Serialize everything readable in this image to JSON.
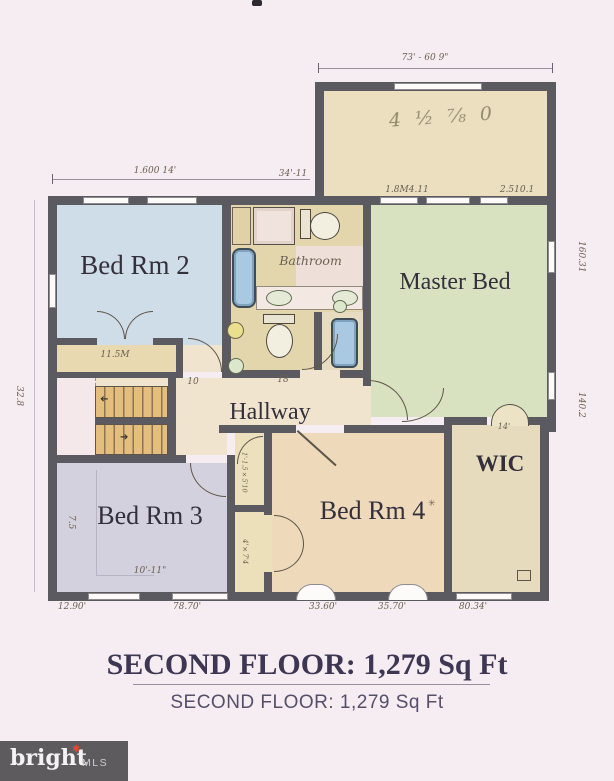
{
  "plan": {
    "rooms": {
      "bed2": "Bed Rm 2",
      "master": "Master Bed",
      "bed3": "Bed Rm 3",
      "bed4": "Bed Rm 4",
      "wic": "WIC",
      "hallway": "Hallway",
      "bathroom": "Bathroom",
      "bonus_note": "4 ½ ⅞ 0"
    },
    "dims": {
      "bonus_top": "73' - 60 9\"",
      "bed2_top": "1.600 14'",
      "top_center": "34'-11",
      "master_top_left": "1.8M4.11",
      "master_top_right": "2.510.1",
      "left_side": "32.8",
      "right_upper": "160.31",
      "right_lower": "140.2",
      "bed3_width": "10'-11\"",
      "bed3_height": "7.5",
      "bed2_closet": "11.5M",
      "hall_closet": "1'-1.5×5'10",
      "bed4_closet": "4'×7'4",
      "wic_top": "14'",
      "stair_note": "10",
      "hall_note": "18"
    },
    "bottom_dims": [
      "12.90'",
      "78.70'",
      "33.60'",
      "35.70'",
      "80.34'"
    ],
    "glyphs": {
      "stair_up_arrow": "➔",
      "stair_down_arrow": "➔",
      "plant_mark": "✳"
    }
  },
  "title": {
    "main": "SECOND FLOOR: 1,279 Sq Ft",
    "sub": "SECOND FLOOR: 1,279 Sq Ft"
  },
  "watermark": {
    "brand": "bright",
    "star": "✱",
    "suffix": "MLS"
  },
  "colors": {
    "background": "#f5edf1",
    "wall": "#5c5a61",
    "bed2_fill": "#cfdde9",
    "master_fill": "#d8e2c0",
    "bed3_fill": "#d3d1de",
    "bed4_fill": "#eed9bb",
    "wic_fill": "#e7dbbd",
    "bonus_fill": "#ebdfc0",
    "hallway_fill": "#f0e4cf",
    "bath_fill": "#e4d6ac",
    "stair_wood": "#e5bd7d",
    "tub_blue": "#a9c9e2",
    "sink_yellow": "#e9df8e",
    "title_color": "#3e3753",
    "watermark_bg": "#5e5b5f",
    "watermark_star": "#d94f30"
  }
}
